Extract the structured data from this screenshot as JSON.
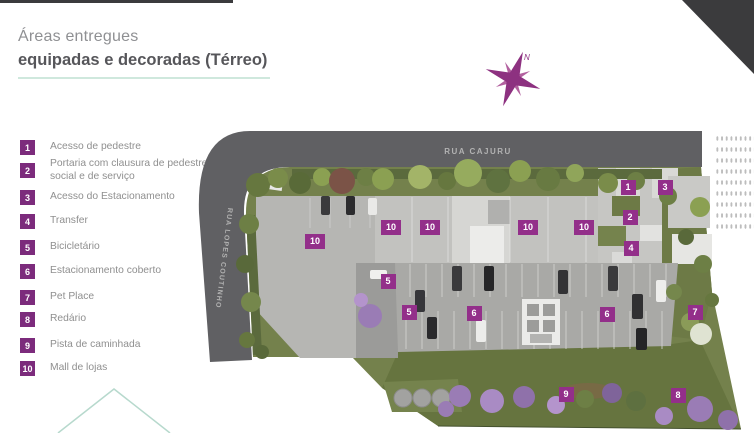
{
  "header": {
    "title_line1": "Áreas entregues",
    "title_line2": "equipadas e decoradas (Térreo)"
  },
  "legend": {
    "items": [
      {
        "num": "1",
        "label": "Acesso de pedestre"
      },
      {
        "num": "2",
        "label": "Portaria com clausura de pedestre social e de serviço"
      },
      {
        "num": "3",
        "label": "Acesso do Estacionamento"
      },
      {
        "num": "4",
        "label": "Transfer"
      },
      {
        "num": "5",
        "label": "Bicicletário"
      },
      {
        "num": "6",
        "label": "Estacionamento coberto"
      },
      {
        "num": "7",
        "label": "Pet Place"
      },
      {
        "num": "8",
        "label": "Redário"
      },
      {
        "num": "9",
        "label": "Pista de caminhada"
      },
      {
        "num": "10",
        "label": "Mall de lojas"
      }
    ]
  },
  "plan": {
    "street_top": "RUA CAJURU",
    "street_left": "RUA LOPES COUTINHO",
    "compass_label": "N",
    "markers": [
      {
        "num": "1",
        "x": 628,
        "y": 187
      },
      {
        "num": "2",
        "x": 630,
        "y": 217
      },
      {
        "num": "3",
        "x": 665,
        "y": 187
      },
      {
        "num": "4",
        "x": 631,
        "y": 248
      },
      {
        "num": "5",
        "x": 388,
        "y": 281
      },
      {
        "num": "5",
        "x": 409,
        "y": 312
      },
      {
        "num": "6",
        "x": 474,
        "y": 313
      },
      {
        "num": "6",
        "x": 607,
        "y": 314
      },
      {
        "num": "7",
        "x": 695,
        "y": 312
      },
      {
        "num": "8",
        "x": 678,
        "y": 395
      },
      {
        "num": "9",
        "x": 566,
        "y": 394
      },
      {
        "num": "10",
        "x": 315,
        "y": 241
      },
      {
        "num": "10",
        "x": 391,
        "y": 227
      },
      {
        "num": "10",
        "x": 430,
        "y": 227
      },
      {
        "num": "10",
        "x": 528,
        "y": 227
      },
      {
        "num": "10",
        "x": 584,
        "y": 227
      }
    ]
  },
  "colors": {
    "legend_purple": "#7c2b7c",
    "marker_purple": "#932f8a",
    "teal_rule": "#cfe8dd",
    "corner_triangle": "#3b3b3d",
    "compass_purple": "#8d3180"
  }
}
